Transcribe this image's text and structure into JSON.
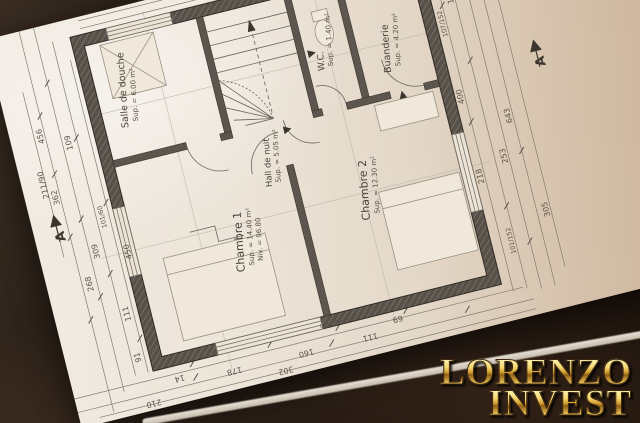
{
  "plan": {
    "rooms": [
      {
        "name": "Salle de douche",
        "sup": "Sup. = 6.00 m²"
      },
      {
        "name": "W.C.",
        "sup": "Sup. = 1.40 m²"
      },
      {
        "name": "Buanderie",
        "sup": "Sup. = 4.20 m²"
      },
      {
        "name": "Hall de nuit",
        "sup": "Sup. = 5.05 m²"
      },
      {
        "name": "Chambre 1",
        "sup": "Sup. = 14.40 m²",
        "niv": "Niv. = 96.80"
      },
      {
        "name": "Chambre 2",
        "sup": "Sup. = 12.30 m²"
      }
    ],
    "dims": {
      "left": [
        "211/90",
        "456",
        "362",
        "450",
        "268",
        "309",
        "109",
        "111",
        "101/60",
        "91"
      ],
      "bottom": [
        "14",
        "178",
        "160",
        "111",
        "69",
        "302",
        "210"
      ],
      "right": [
        "107/152",
        "149",
        "643",
        "253",
        "218",
        "400",
        "305",
        "101/152"
      ],
      "top": [
        "205",
        "90"
      ]
    },
    "annotations": {
      "allege": "Hk 26cm"
    },
    "section_markers": {
      "left": "A",
      "right": "A"
    }
  },
  "watermark": {
    "line1": "LORENZO",
    "line2": "INVEST",
    "gold": "#e8b83a"
  }
}
